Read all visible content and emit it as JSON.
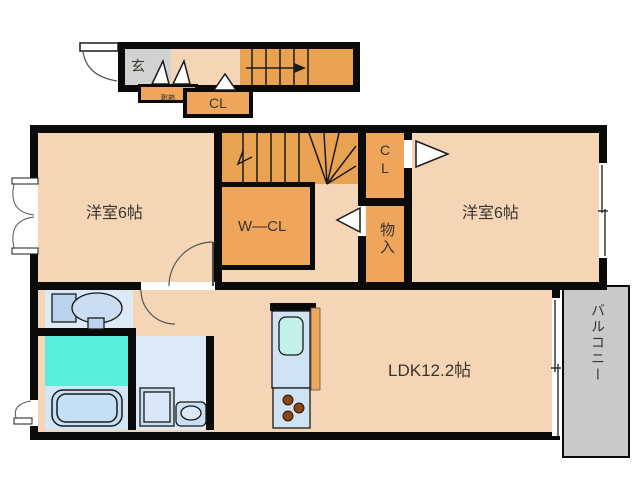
{
  "first_floor": {
    "entrance": "玄",
    "shoe_cabinet": "靴箱",
    "closet": "CL"
  },
  "second_floor": {
    "bedroom_left": "洋室6帖",
    "bedroom_right": "洋室6帖",
    "walk_in_closet": "W―CL",
    "closet": "CL",
    "storage": "物入",
    "ldk": "LDK12.2帖",
    "balcony": "バルコニー"
  },
  "colors": {
    "wall": "#0a0a0a",
    "room_peach": "#F4D6B7",
    "closet_orange": "#EFA55C",
    "stairs_orange": "#E9A252",
    "entrance_gray": "#D2D2D2",
    "balcony_gray": "#C9C9C9",
    "sanitary_blue": "#DCE9F6",
    "bath_cyan": "#58EEDA",
    "fixture_blue": "#CFE3F5",
    "burner_brown": "#8A4613"
  }
}
